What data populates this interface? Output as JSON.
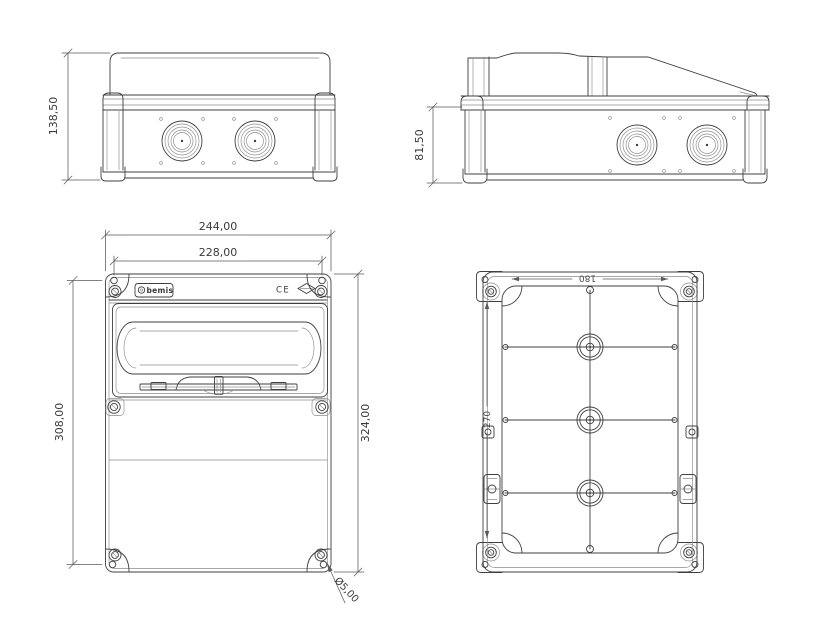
{
  "dims": {
    "side_height": "138,50",
    "base_height": "81,50",
    "width_outer": "244,00",
    "width_mounting": "228,00",
    "height_mounting": "308,00",
    "height_outer": "324,00",
    "hole_diameter": "Ø5,00",
    "inner_width": "180",
    "inner_height": "270"
  },
  "branding": {
    "brand": "bemis",
    "ce": "CE"
  },
  "colors": {
    "line": "#3f3f3f",
    "line_light": "#8c8c8c",
    "text": "#3a3a3a",
    "background": "#ffffff"
  }
}
